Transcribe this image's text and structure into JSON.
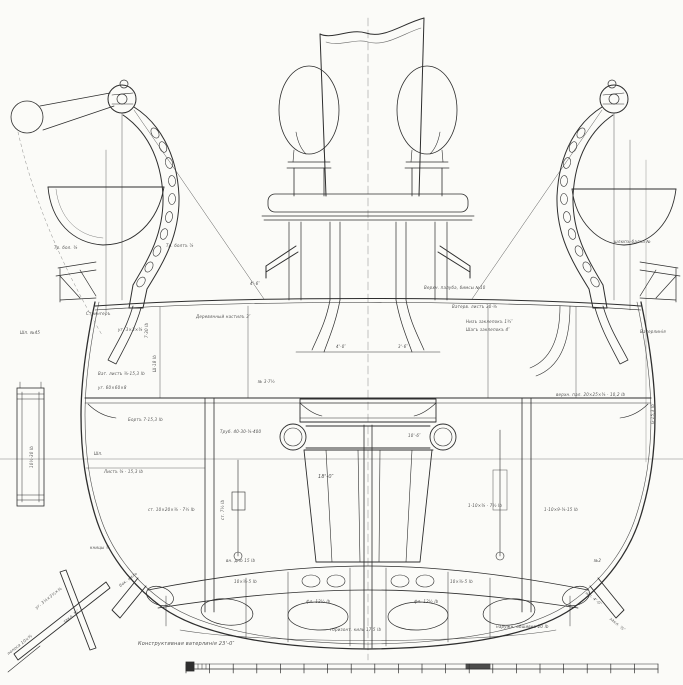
{
  "colors": {
    "paper": "#fbfbf8",
    "ink": "#2e2e2e",
    "faint": "#8a8a8a"
  },
  "scale_bar": {
    "x_start": 186,
    "x_end": 658,
    "y_top": 664,
    "y_base": 669,
    "tick_bottom": 673,
    "major_segments": 20,
    "minor_step": 4
  },
  "annotations": [
    {
      "x": 196,
      "y": 314,
      "text": "Деревянный настилъ 3″"
    },
    {
      "x": 424,
      "y": 285,
      "text": "Верхн. палуба, бимсы №10"
    },
    {
      "x": 452,
      "y": 304,
      "text": "Ватерв. листъ 30·⅜"
    },
    {
      "x": 466,
      "y": 319,
      "text": "Низъ заклепокъ 1¾″"
    },
    {
      "x": 466,
      "y": 327,
      "text": "Шагъ заклепокъ 4″"
    },
    {
      "x": 556,
      "y": 392,
      "text": "верхн. пал. 20×25×⅜ · 10,2 lb"
    },
    {
      "x": 86,
      "y": 311,
      "text": "Стрингеръ"
    },
    {
      "x": 118,
      "y": 327,
      "text": "уг. 3×3×⅜"
    },
    {
      "x": 144,
      "y": 338,
      "text": "7·30 lb",
      "rot": -90
    },
    {
      "x": 152,
      "y": 372,
      "text": "Ш·18 lb",
      "rot": -90
    },
    {
      "x": 20,
      "y": 330,
      "text": "Шп. №45"
    },
    {
      "x": 98,
      "y": 371,
      "text": "Ват. листъ ⅜·15,3 lb"
    },
    {
      "x": 98,
      "y": 385,
      "text": "уг. 60×60×8"
    },
    {
      "x": 128,
      "y": 417,
      "text": "Бортъ 7·15,3 lb"
    },
    {
      "x": 29,
      "y": 468,
      "text": "10½·30 lb",
      "rot": -90
    },
    {
      "x": 94,
      "y": 451,
      "text": "Шп."
    },
    {
      "x": 104,
      "y": 469,
      "text": "Листъ ⅜ · 15,3 lb"
    },
    {
      "x": 148,
      "y": 507,
      "text": "ст. 10×20×⅜ · 7½ lb"
    },
    {
      "x": 90,
      "y": 545,
      "text": "кницы ⅜"
    },
    {
      "x": 118,
      "y": 584,
      "text": "бок. киль",
      "rot": -38
    },
    {
      "x": 34,
      "y": 606,
      "text": "уг. 3½×3½×⅜",
      "rot": -38
    },
    {
      "x": 62,
      "y": 620,
      "text": "закл. ¾″",
      "rot": -38
    },
    {
      "x": 6,
      "y": 652,
      "text": "полоса 10×⅜",
      "rot": -38
    },
    {
      "x": 220,
      "y": 429,
      "text": "Труб. 40·30·⅜·400"
    },
    {
      "x": 250,
      "y": 281,
      "text": "4'-6″"
    },
    {
      "x": 318,
      "y": 474,
      "text": "18'-0″",
      "big": true
    },
    {
      "x": 336,
      "y": 344,
      "text": "4'-0″"
    },
    {
      "x": 398,
      "y": 344,
      "text": "3'-6″"
    },
    {
      "x": 258,
      "y": 379,
      "text": "№ 3·7½"
    },
    {
      "x": 408,
      "y": 433,
      "text": "10'-6″"
    },
    {
      "x": 468,
      "y": 503,
      "text": "1·10×⅜ · 7½ lb"
    },
    {
      "x": 220,
      "y": 520,
      "text": "ст. 7½ lb",
      "rot": -90
    },
    {
      "x": 226,
      "y": 558,
      "text": "вн. дно 15 lb"
    },
    {
      "x": 306,
      "y": 599,
      "text": "фл. 12½ lb"
    },
    {
      "x": 414,
      "y": 599,
      "text": "фл. 12½ lb"
    },
    {
      "x": 330,
      "y": 627,
      "text": "горизонт. киль 17,5 lb"
    },
    {
      "x": 234,
      "y": 579,
      "text": "10×⅜·5 lb"
    },
    {
      "x": 450,
      "y": 579,
      "text": "10×⅜·5 lb"
    },
    {
      "x": 496,
      "y": 624,
      "text": "наружн. обшивка 20 lb"
    },
    {
      "x": 544,
      "y": 507,
      "text": "1·10×9·⅜·15 lb"
    },
    {
      "x": 594,
      "y": 558,
      "text": "№2"
    },
    {
      "x": 588,
      "y": 590,
      "text": "шп. 4'-0″",
      "rot": 40
    },
    {
      "x": 612,
      "y": 616,
      "text": "закл. ⅞″",
      "rot": 40
    },
    {
      "x": 138,
      "y": 641,
      "text": "Конструктивная ватерлинiя 23'-0″",
      "big": true
    },
    {
      "x": 640,
      "y": 329,
      "text": "Ватерлинiя"
    },
    {
      "x": 650,
      "y": 424,
      "text": "G·15,3 lb",
      "rot": -90
    },
    {
      "x": 614,
      "y": 239,
      "text": "шлюпъ-балка №"
    },
    {
      "x": 166,
      "y": 243,
      "text": "Тр. болтъ ⅞"
    },
    {
      "x": 54,
      "y": 245,
      "text": "Тр. бол. ⅜"
    }
  ]
}
